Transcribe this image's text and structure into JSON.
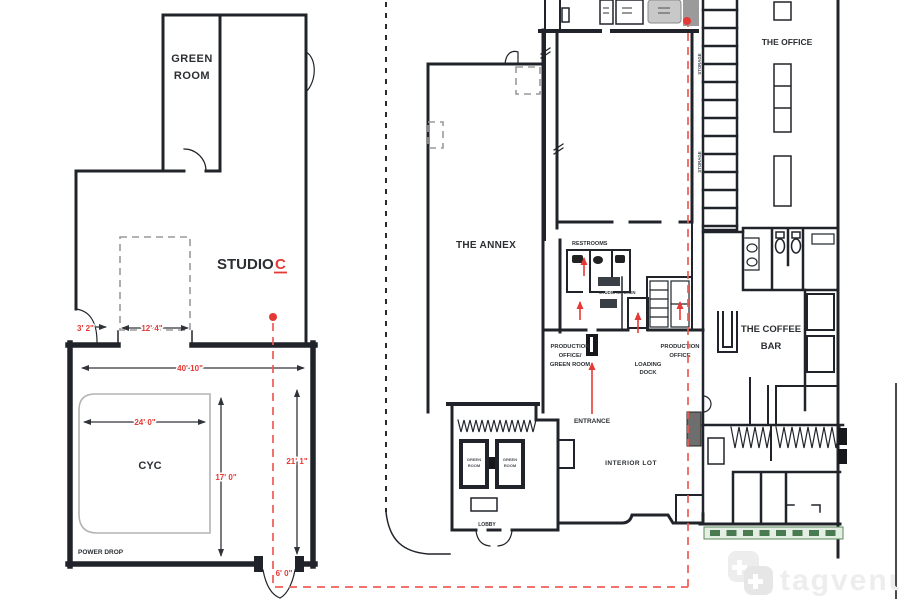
{
  "colors": {
    "wall": "#20242a",
    "accent_red": "#e53935",
    "dash_red": "#ee5a54",
    "hedge_green": "#4a7a50",
    "watermark_gray": "#ededed"
  },
  "studio_c": {
    "green_room_line1": "GREEN",
    "green_room_line2": "ROOM",
    "title_word": "STUDIO",
    "title_letter": "C",
    "cyc": "CYC",
    "power_drop": "POWER DROP",
    "dim_door": "3' 2\"",
    "dim_opening": "12' 4\"",
    "dim_width": "40' 10\"",
    "dim_cyc_width": "24' 0\"",
    "dim_cyc_depth": "17' 0\"",
    "dim_right": "21' 1\"",
    "dim_exit": "6' 0\""
  },
  "annex": {
    "title": "THE ANNEX",
    "restrooms": "RESTROOMS",
    "studio_kitchen": "STUDIO KITCHEN",
    "prod_office_gr_1": "PRODUCTION",
    "prod_office_gr_2": "OFFICE/",
    "prod_office_gr_3": "GREEN ROOM",
    "loading_dock_1": "LOADING",
    "loading_dock_2": "DOCK",
    "prod_office_1": "PRODUCTION",
    "prod_office_2": "OFFICE",
    "entrance": "ENTRANCE",
    "interior_lot": "INTERIOR LOT",
    "lobby": "LOBBY",
    "green_room_a_1": "GREEN",
    "green_room_a_2": "ROOM",
    "green_room_b_1": "GREEN",
    "green_room_b_2": "ROOM",
    "storage_1": "STORAGE",
    "storage_2": "STORAGE"
  },
  "office": {
    "title": "THE OFFICE",
    "coffee_bar_1": "THE COFFEE",
    "coffee_bar_2": "BAR"
  },
  "watermark": {
    "brand": "tagvenue"
  }
}
